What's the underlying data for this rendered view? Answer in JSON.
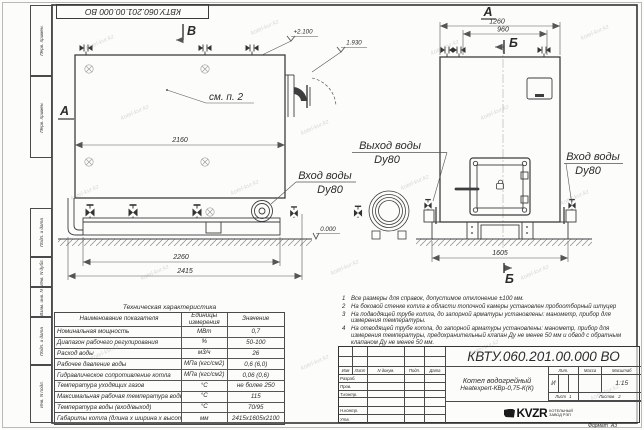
{
  "watermark": "kotel-kvr.kz",
  "top_stamp": "КВТУ.060.201.00.000  ВО",
  "margin_labels": {
    "perv1": "Перв. примен.",
    "perv2": "Перв. примен.",
    "podp1": "Подп. и дата",
    "inv_dubl": "Инв. N дубл.",
    "vzam": "Взам. инв. N",
    "podp2": "Подп. и дата",
    "inv_podl": "Инв. N подл."
  },
  "drawing": {
    "section_v": "В",
    "section_a_left": "А",
    "view_a_label": "А",
    "section_b_top": "Б",
    "section_b_bottom": "Б",
    "see_item": "см. п. 2",
    "elev_top": "+2.100",
    "elev_flue": "1.930",
    "elev_zero": "0.000",
    "dims": {
      "d2160": "2160",
      "d2260": "2260",
      "d2415": "2415",
      "d1260": "1260",
      "d960": "960",
      "d1605": "1605"
    },
    "labels": {
      "outlet_line1": "Выход воды",
      "outlet_line2": "Dy80",
      "inlet_side_line1": "Вход воды",
      "inlet_side_line2": "Dy80",
      "inlet_front_line1": "Вход воды",
      "inlet_front_line2": "Dy80"
    }
  },
  "tech_table": {
    "title": "Техническая характеристика",
    "col_name": "Наименование показателя",
    "col_units": "Единицы измерения",
    "col_value": "Значение",
    "rows": [
      {
        "name": "Номинальная мощность",
        "units": "МВт",
        "value": "0,7"
      },
      {
        "name": "Диапазон рабочего регулирования",
        "units": "%",
        "value": "50-100"
      },
      {
        "name": "Расход воды",
        "units": "м3/ч",
        "value": "26"
      },
      {
        "name": "Рабочее давление воды",
        "units": "МПа (кгс/см2)",
        "value": "0,6 (6,0)"
      },
      {
        "name": "Гидравлическое сопротивление котла",
        "units": "МПа (кгс/см2)",
        "value": "0,06 (0,6)"
      },
      {
        "name": "Температура уходящих газов",
        "units": "°С",
        "value": "не более 250"
      },
      {
        "name": "Максимальная рабочая температура воды",
        "units": "°С",
        "value": "115"
      },
      {
        "name": "Температура воды (вход/выход)",
        "units": "°С",
        "value": "70/95"
      },
      {
        "name": "Габариты котла (длина х ширина х высота)",
        "units": "мм",
        "value": "2415х1605х2100"
      }
    ]
  },
  "notes": [
    {
      "num": "1",
      "text": "Все размеры для справок, допустимое отклонение ±100 мм."
    },
    {
      "num": "2",
      "text": "На боковой стенке котла в области топочной камеры установлен пробоотборный штуцер"
    },
    {
      "num": "3",
      "text": "На подводящей трубе котла, до запорной арматуры установлены: манометр, прибор для измерения температуры."
    },
    {
      "num": "4",
      "text": "На отводящей трубе котла, до запорной арматуры установлены: манометр, прибор для измерения температуры, предохранительный клапан Ду не менее 50 мм и обвод с обратным клапаном Ду не менее 50 мм."
    }
  ],
  "title_block": {
    "doc_number": "КВТУ.060.201.00.000  ВО",
    "col_izm": "Изм",
    "col_list": "Лист",
    "col_ndok": "N докум.",
    "col_podp": "Подп.",
    "col_data": "Дата",
    "row_razrab": "Разраб.",
    "row_prov": "Пров.",
    "row_tkontr": "Т.контр.",
    "row_nkontr": "Н.контр.",
    "row_utv": "Утв.",
    "product_line1": "Котел водогрейный",
    "product_line2": "Heatexpert-КВр-0,75-К(К)",
    "lit_label": "Лит.",
    "mass_label": "Масса",
    "scale_label": "Масштаб",
    "lit_value": "И",
    "scale_value": "1:15",
    "sheet_label": "Лист",
    "sheet_value": "1",
    "sheets_label": "Листов",
    "sheets_value": "2",
    "logo": "KVZR",
    "logo_sub1": "КОТЕЛЬНЫЙ",
    "logo_sub2": "ЗАВОД РЭП",
    "format_label": "Формат",
    "format_value": "А3"
  }
}
